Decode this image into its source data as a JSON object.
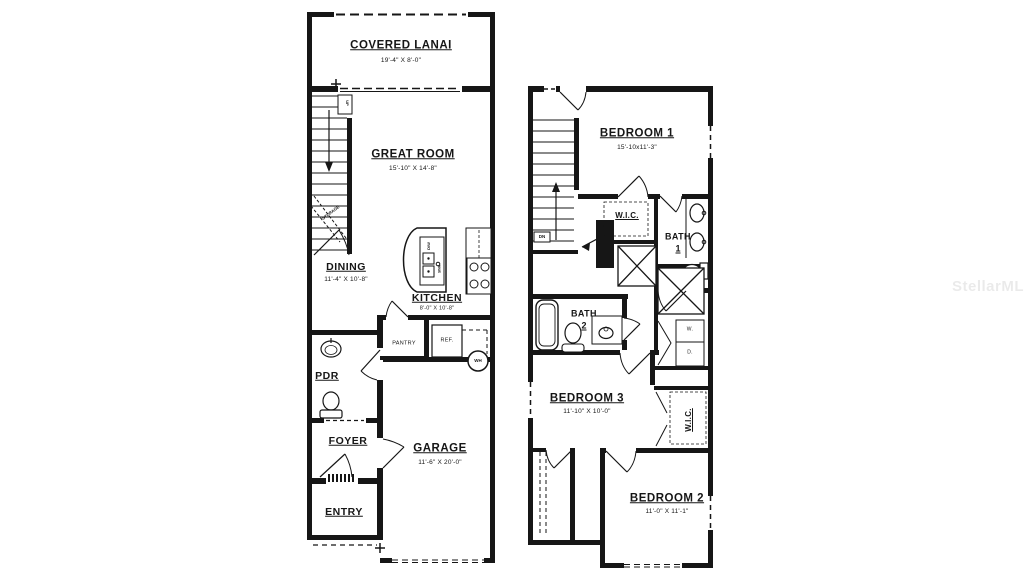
{
  "watermark": "StellarMLS",
  "floor1": {
    "covered_lanai_name": "COVERED LANAI",
    "covered_lanai_dims": "19'-4\" X 8'-0\"",
    "great_room_name": "GREAT ROOM",
    "great_room_dims": "15'-10\" X 14'-8\"",
    "dining_name": "DINING",
    "dining_dims": "11'-4\" X 10'-8\"",
    "kitchen_name": "KITCHEN",
    "kitchen_dims": "8'-0\" X 10'-8\"",
    "garage_name": "GARAGE",
    "garage_dims": "11'-6\" X 20'-0\"",
    "pdr_name": "PDR",
    "foyer_name": "FOYER",
    "entry_name": "ENTRY",
    "pantry_name": "PANTRY",
    "ref_name": "REF.",
    "wh_name": "WH",
    "dw_name": "D/W",
    "sink_name": "SINK",
    "storage_name": "STORAGE",
    "up_name": "UP"
  },
  "floor2": {
    "bedroom1_name": "BEDROOM 1",
    "bedroom1_dims": "15'-10x11'-3\"",
    "bedroom2_name": "BEDROOM 2",
    "bedroom2_dims": "11'-0\" X 11'-1\"",
    "bedroom3_name": "BEDROOM 3",
    "bedroom3_dims": "11'-10\" X 10'-0\"",
    "bath1_line1": "BATH",
    "bath1_line2": "1",
    "bath2_line1": "BATH",
    "bath2_line2": "2",
    "wic1_name": "W.I.C.",
    "wic2_name": "W.I.C.",
    "washer_name": "W.",
    "dryer_name": "D.",
    "dn_name": "DN"
  }
}
